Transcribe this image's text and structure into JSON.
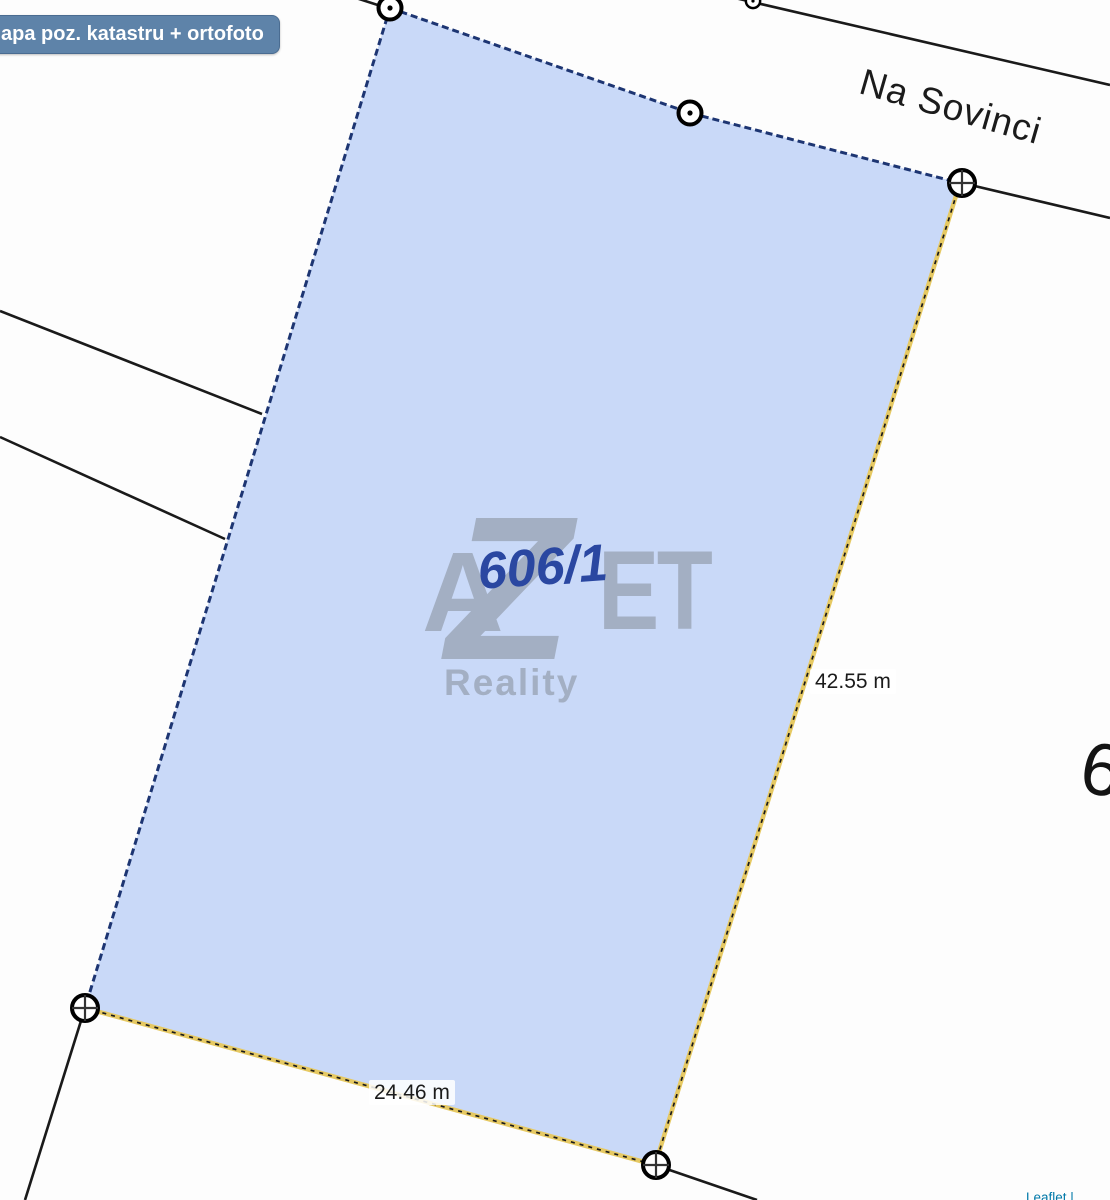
{
  "colors": {
    "background": "#fdfdfd",
    "boundary_line": "#1a1a1a",
    "parcel_fill": "#c9d9f8",
    "parcel_border": "#1d3572",
    "measure_line_yellow": "#e6c963",
    "parcel_number_blue": "#2a47a1",
    "watermark_gray": "#828a94",
    "button_bg": "#5e83a9",
    "button_text": "#ffffff",
    "attribution_blue": "#0078a8"
  },
  "button": {
    "label": "apa poz. katastru + ortofoto"
  },
  "street": {
    "name": "Na Sovinci"
  },
  "parcel": {
    "number": "606/1",
    "points": "390,8 690,113 960,183 655,1165 85,1008"
  },
  "measurements": {
    "right_edge": "42.55 m",
    "bottom_edge": "24.46 m"
  },
  "neighbor": {
    "partial_number": "6"
  },
  "watermark": {
    "letter_a": "A",
    "letter_z": "Z",
    "letters_et": "ET",
    "subtitle": "Reality"
  },
  "attribution": {
    "text": "Leaflet |"
  },
  "boundary_lines": [
    {
      "x1": 735,
      "y1": -2,
      "x2": 1110,
      "y2": 85
    },
    {
      "x1": 962,
      "y1": 183,
      "x2": 1110,
      "y2": 218
    },
    {
      "x1": 0,
      "y1": 311,
      "x2": 262,
      "y2": 414
    },
    {
      "x1": 0,
      "y1": 437,
      "x2": 225,
      "y2": 539
    },
    {
      "x1": 85,
      "y1": 1008,
      "x2": 25,
      "y2": 1200
    },
    {
      "x1": 655,
      "y1": 1165,
      "x2": 757,
      "y2": 1200
    },
    {
      "x1": 356,
      "y1": -2,
      "x2": 390,
      "y2": 9
    }
  ],
  "measure_lines": [
    {
      "x1": 960,
      "y1": 183,
      "x2": 655,
      "y2": 1165
    },
    {
      "x1": 85,
      "y1": 1008,
      "x2": 655,
      "y2": 1165
    }
  ],
  "markers": {
    "dot": [
      "translate(390,8)",
      "translate(690,113)",
      "translate(753,1) scale(0.62)"
    ],
    "cross": [
      "translate(962,183)",
      "translate(656,1165)",
      "translate(85,1008)"
    ]
  }
}
